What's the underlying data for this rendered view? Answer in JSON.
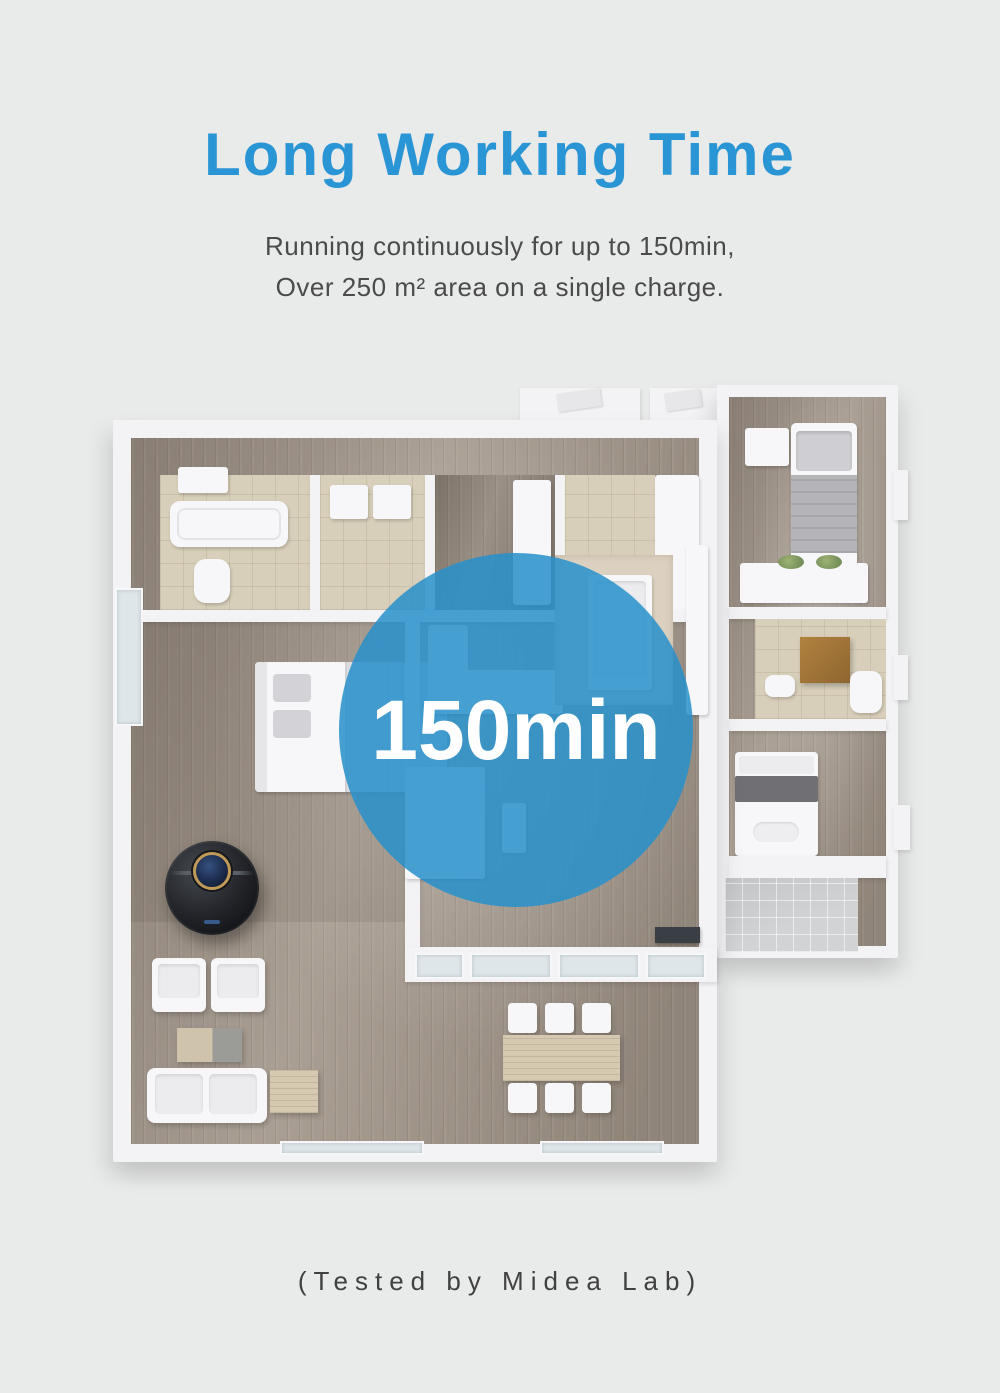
{
  "theme": {
    "background": "#e9eaea",
    "accent_blue": "#2a95d5",
    "badge_fill": "rgba(40,144,203,0.86)",
    "badge_text_color": "#ffffff",
    "subtitle_text_color": "#4b4b4b",
    "footer_text_color": "#414141"
  },
  "header": {
    "title": "Long Working Time",
    "subtitle_line1": "Running continuously for up to 150min,",
    "subtitle_line2": "Over 250 m² area on a single charge."
  },
  "badge": {
    "text": "150min"
  },
  "footer": {
    "note": "(Tested by Midea Lab)"
  }
}
